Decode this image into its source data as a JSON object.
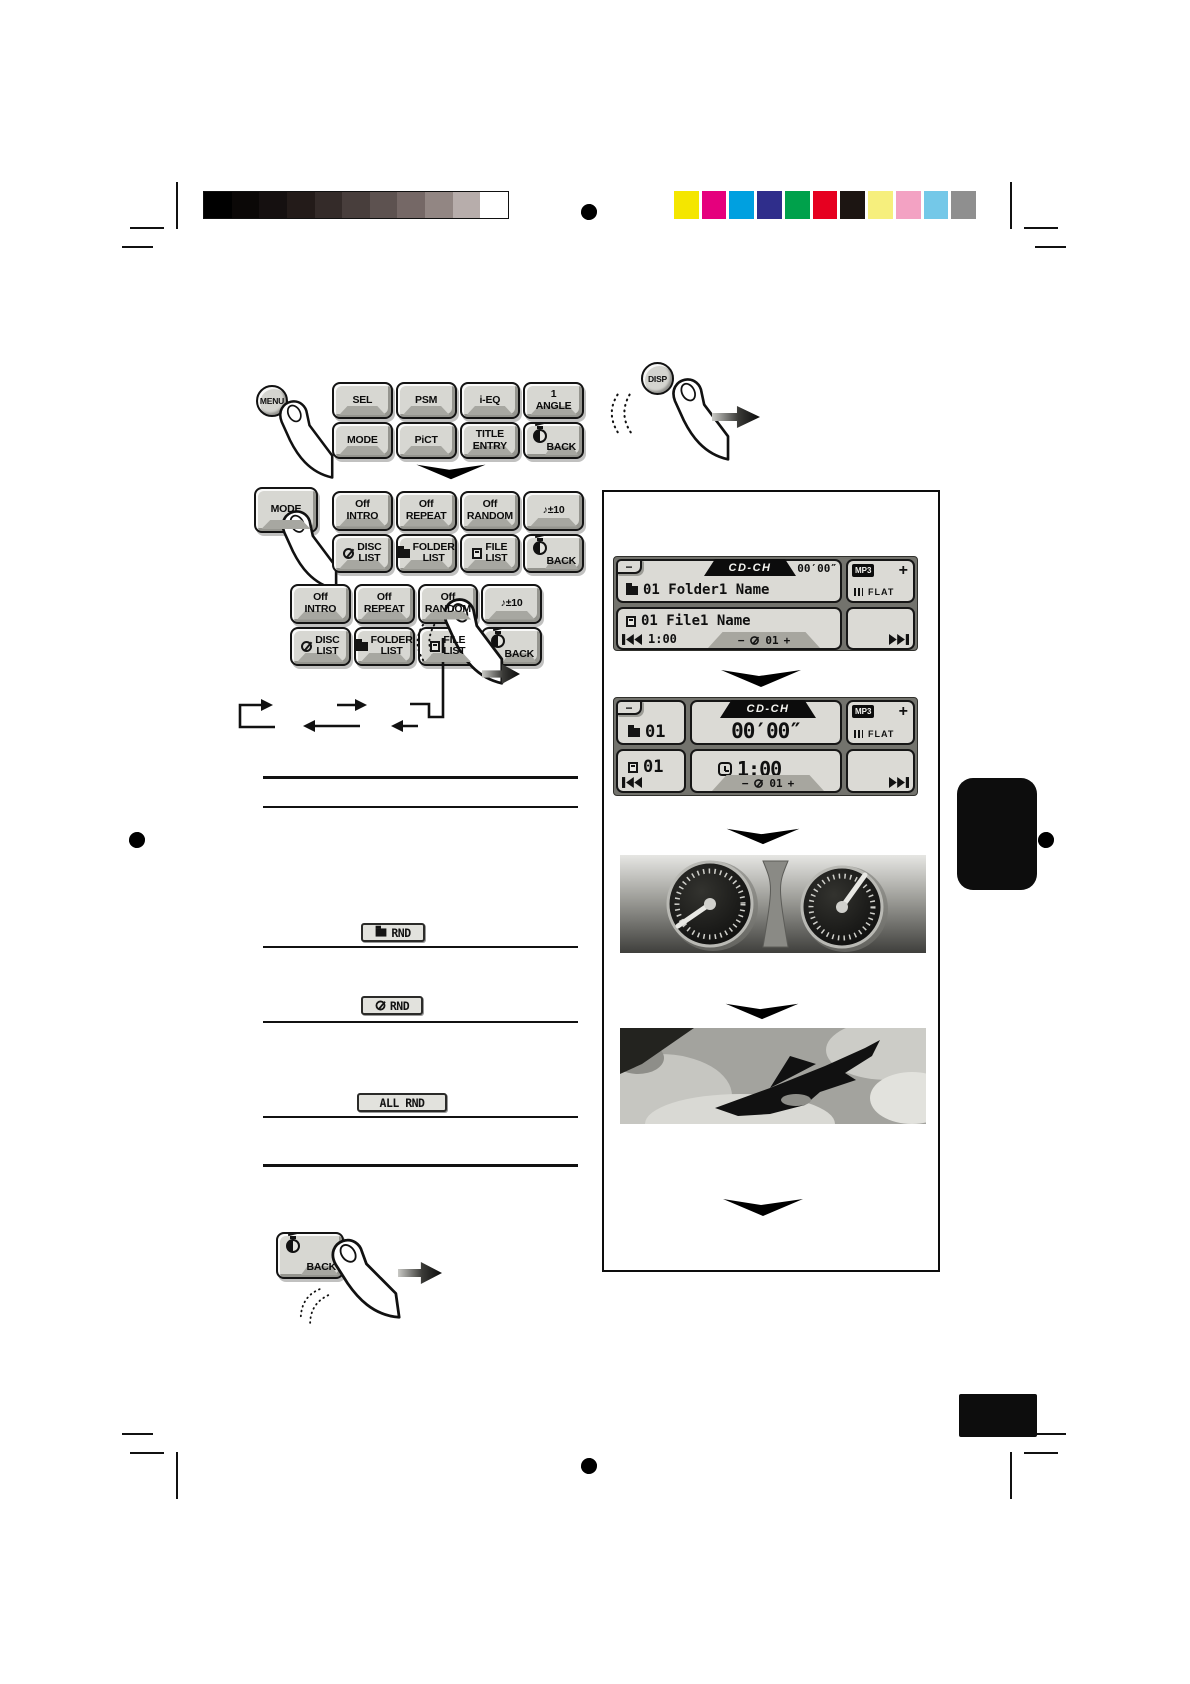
{
  "print_marks": {
    "grayscale_swatches": [
      "#000000",
      "#0b0807",
      "#151010",
      "#231b19",
      "#342b29",
      "#483e3c",
      "#5d5250",
      "#756866",
      "#928683",
      "#b7adab",
      "#ffffff"
    ],
    "color_swatches": [
      "#f4e600",
      "#e5007d",
      "#00a0e0",
      "#2f2e8b",
      "#00a14b",
      "#e60020",
      "#1c1512",
      "#f6ef7d",
      "#f3a2c3",
      "#74c8e8",
      "#8f8f8f"
    ]
  },
  "remote": {
    "menu_button": "MENU",
    "mode_button": "MODE",
    "disp_button": "DISP"
  },
  "menu_grid": {
    "buttons": [
      {
        "label": "SEL"
      },
      {
        "label": "PSM"
      },
      {
        "label": "i-EQ"
      },
      {
        "label": "1\nANGLE"
      },
      {
        "label": "MODE"
      },
      {
        "label": "PiCT"
      },
      {
        "label": "TITLE\nENTRY"
      },
      {
        "label": "BACK",
        "icon": "timer"
      }
    ]
  },
  "mode_grid": {
    "buttons": [
      {
        "label": "Off\nINTRO"
      },
      {
        "label": "Off\nREPEAT"
      },
      {
        "label": "Off\nRANDOM"
      },
      {
        "label": "♪±10"
      },
      {
        "label": "DISC\nLIST",
        "icon": "disc"
      },
      {
        "label": "FOLDER\nLIST",
        "icon": "folder"
      },
      {
        "label": "FILE\nLIST",
        "icon": "file"
      },
      {
        "label": "BACK",
        "icon": "timer"
      }
    ]
  },
  "random_grid": {
    "buttons": [
      {
        "label": "Off\nINTRO"
      },
      {
        "label": "Off\nREPEAT"
      },
      {
        "label": "Off\nRANDOM"
      },
      {
        "label": "♪±10"
      },
      {
        "label": "DISC\nLIST",
        "icon": "disc"
      },
      {
        "label": "FOLDER\nLIST",
        "icon": "folder"
      },
      {
        "label": "FILE\nLIST",
        "icon": "file"
      },
      {
        "label": "BACK",
        "icon": "timer"
      }
    ]
  },
  "random_indicators": [
    {
      "icon_class": "bic icon-folder",
      "label": "RND"
    },
    {
      "icon_class": "bic icon-disc",
      "label": "RND"
    },
    {
      "icon_class": "none",
      "label": "ALL RND"
    }
  ],
  "back_key": {
    "label": "BACK"
  },
  "screen1": {
    "minus_tab": "−",
    "source": "CD-CH",
    "counter": "00′00″",
    "mp3": "MP3",
    "plus": "+",
    "eq": "FLAT",
    "folder_line": "01 Folder1 Name",
    "file_line": "01 File1 Name",
    "time": "1:00",
    "strip": {
      "minus": "−",
      "disc_num": "01",
      "plus": "+"
    }
  },
  "screen2": {
    "minus_tab": "−",
    "source": "CD-CH",
    "counter": "00′00″",
    "mp3": "MP3",
    "plus": "+",
    "eq": "FLAT",
    "folder_num": "01",
    "file_num": "01",
    "time": "1:00",
    "strip": {
      "minus": "−",
      "disc_num": "01",
      "plus": "+"
    }
  }
}
